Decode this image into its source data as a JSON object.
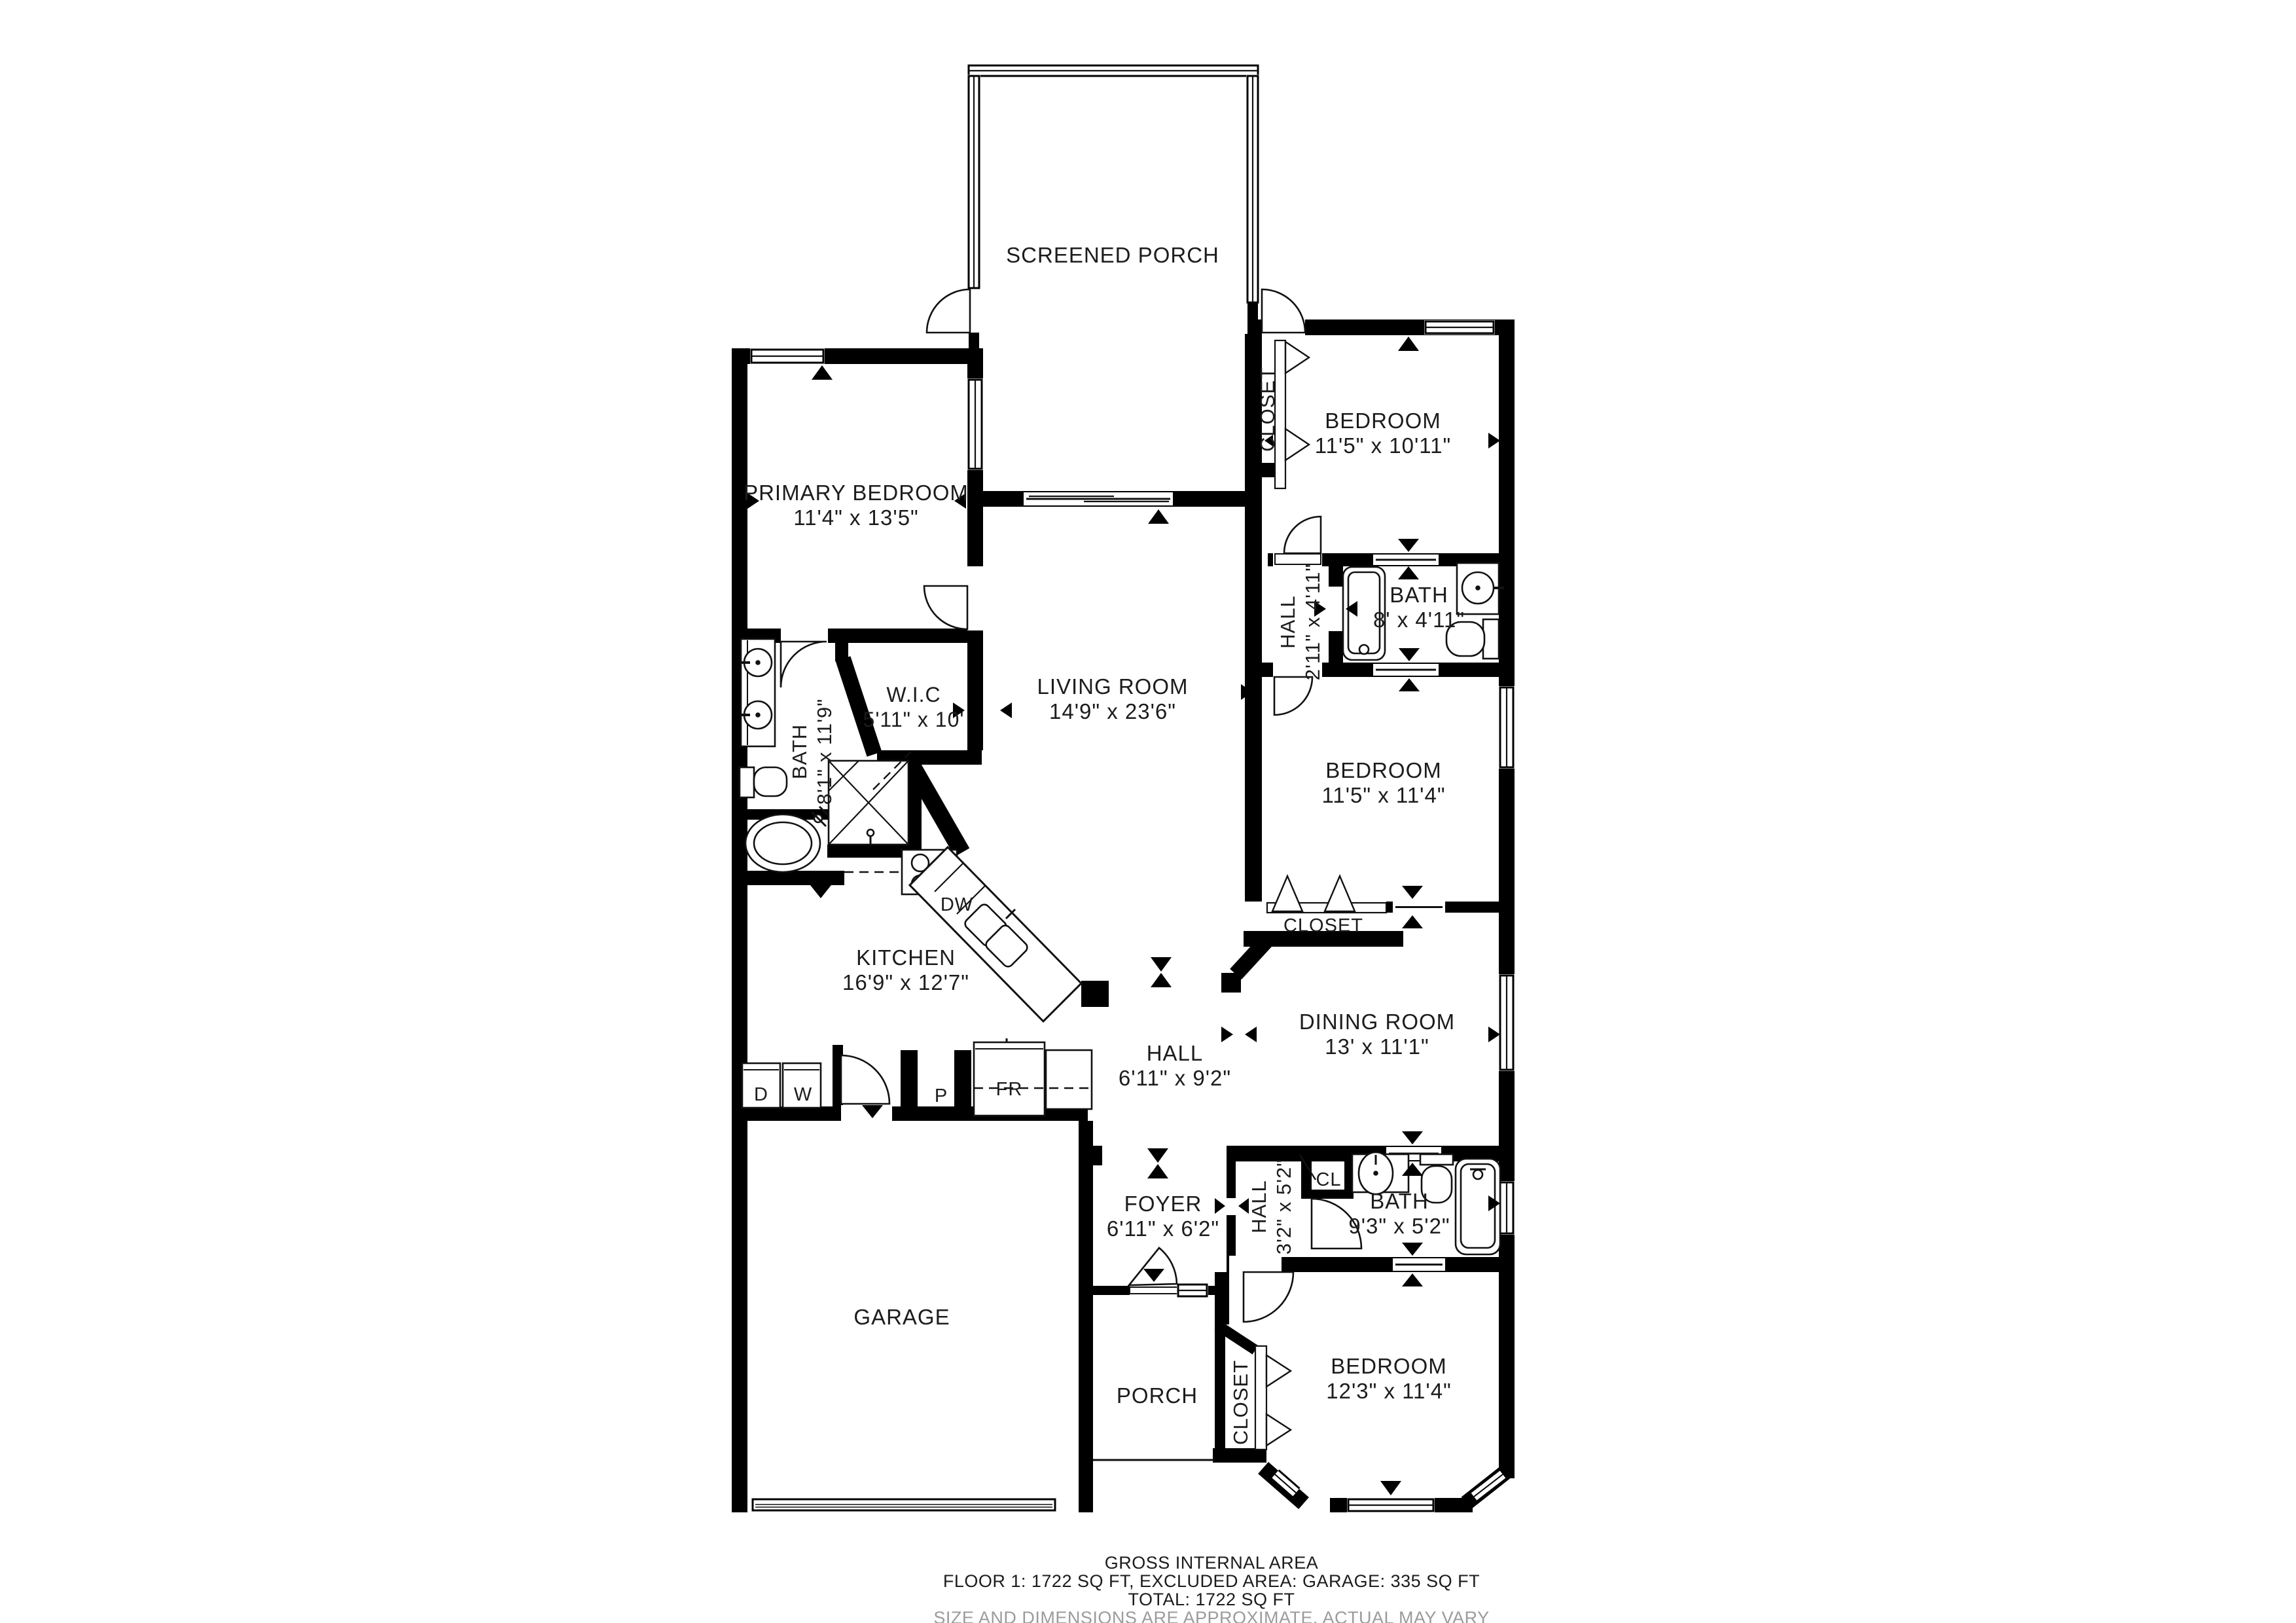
{
  "title": "Floor plan",
  "colors": {
    "wall": "#000000",
    "text": "#1c1c1c",
    "muted": "#9b9b9b",
    "background": "#ffffff"
  },
  "rooms": {
    "screened_porch": {
      "name": "SCREENED PORCH"
    },
    "primary_bedroom": {
      "name": "PRIMARY BEDROOM",
      "dims": "11'4\" x 13'5\""
    },
    "bedroom_top_right": {
      "name": "BEDROOM",
      "dims": "11'5\" x 10'11\""
    },
    "closet_top_right": {
      "name": "CLOSET"
    },
    "hall_top_right": {
      "name": "HALL",
      "dims": "2'11\" x 4'11\""
    },
    "bath_top_right": {
      "name": "BATH",
      "dims": "8' x 4'11\""
    },
    "wic": {
      "name": "W.I.C",
      "dims": "5'11\" x 10'"
    },
    "living_room": {
      "name": "LIVING ROOM",
      "dims": "14'9\" x 23'6\""
    },
    "primary_bath": {
      "name": "BATH",
      "dims": "8'1\" x 11'9\""
    },
    "bedroom_mid_right": {
      "name": "BEDROOM",
      "dims": "11'5\" x 11'4\""
    },
    "closet_mid_right": {
      "name": "CLOSET"
    },
    "kitchen": {
      "name": "KITCHEN",
      "dims": "16'9\" x 12'7\""
    },
    "dining_room": {
      "name": "DINING ROOM",
      "dims": "13' x 11'1\""
    },
    "hall_center": {
      "name": "HALL",
      "dims": "6'11\" x 9'2\""
    },
    "appliance_dryer": {
      "name": "D"
    },
    "appliance_washer": {
      "name": "W"
    },
    "pantry": {
      "name": "P"
    },
    "fridge": {
      "name": "FR"
    },
    "dishwasher": {
      "name": "DW"
    },
    "foyer": {
      "name": "FOYER",
      "dims": "6'11\" x 6'2\""
    },
    "hall_lower": {
      "name": "HALL",
      "dims": "3'2\" x 5'2\""
    },
    "closet_cl": {
      "name": "CL"
    },
    "bath_lower": {
      "name": "BATH",
      "dims": "9'3\" x 5'2\""
    },
    "garage": {
      "name": "GARAGE"
    },
    "porch": {
      "name": "PORCH"
    },
    "closet_bottom": {
      "name": "CLOSET"
    },
    "bedroom_bottom": {
      "name": "BEDROOM",
      "dims": "12'3\" x 11'4\""
    }
  },
  "footer": {
    "line1": "GROSS INTERNAL AREA",
    "line2": "FLOOR 1: 1722 SQ FT, EXCLUDED AREA: GARAGE: 335 SQ FT",
    "line3": "TOTAL: 1722 SQ FT",
    "disclaimer": "SIZE AND DIMENSIONS ARE APPROXIMATE, ACTUAL MAY VARY"
  }
}
